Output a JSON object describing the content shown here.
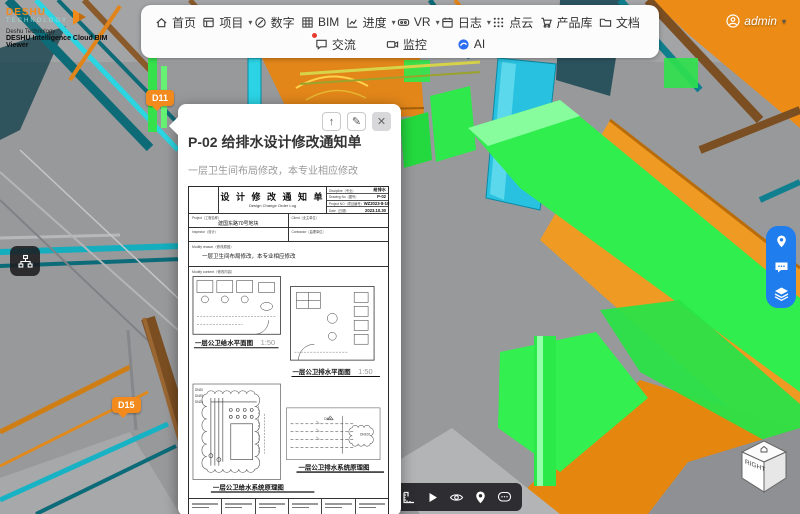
{
  "brand": {
    "logo_line1": "DESHU",
    "logo_line2": "TECHNOLOGY",
    "sub_line1": "Deshu Technology",
    "sub_line2": "DESHU Intelligence Cloud BIM Viewer"
  },
  "nav": {
    "row1": [
      {
        "label": "首页",
        "caret": ""
      },
      {
        "label": "项目",
        "caret": "▾"
      },
      {
        "label": "数字",
        "caret": ""
      },
      {
        "label": "BIM",
        "caret": ""
      },
      {
        "label": "进度",
        "caret": "▾"
      },
      {
        "label": "VR",
        "caret": "▾"
      },
      {
        "label": "日志",
        "caret": "▾"
      },
      {
        "label": "点云",
        "caret": ""
      },
      {
        "label": "产品库",
        "caret": ""
      },
      {
        "label": "文档",
        "caret": ""
      }
    ],
    "row2": [
      {
        "label": "交流"
      },
      {
        "label": "监控"
      },
      {
        "label": "AI"
      }
    ]
  },
  "user": {
    "name": "admin",
    "caret": "▾"
  },
  "markers": {
    "d11": "D11",
    "d15": "D15"
  },
  "popup": {
    "title": "P-02 给排水设计修改通知单",
    "subtitle": "一层卫生间布局修改，本专业相应修改",
    "actions": {
      "share": "↑",
      "edit": "✎",
      "close": "✕"
    },
    "doc": {
      "title_cn": "设 计 修 改 通 知 单",
      "title_en": "Design Change Order Log",
      "meta": [
        {
          "label": "Discipline（专业）",
          "value": "给排水"
        },
        {
          "label": "Drawing No（图号）",
          "value": "P-02"
        },
        {
          "label": "Project NO（项目编号）",
          "value": "WZ2023-8-10"
        },
        {
          "label": "Date（日期）",
          "value": "2023.10.30"
        }
      ],
      "info_rows": [
        {
          "l1": "Project（工程名称）",
          "v1": "建国东路70号地块",
          "l2": "Client（业主单位）",
          "v2": ""
        },
        {
          "l1": "Inspector（设计）",
          "v1": "",
          "l2": "Contractor（监理单位）",
          "v2": ""
        }
      ],
      "reason_label": "Modify reason（修改原因）",
      "reason_text": "一层卫生间布局修改，本专业相应修改",
      "content_label": "Modify content（修改内容）",
      "drawings": {
        "plan_water_caption": "一层公卫给水平面图",
        "plan_drain_caption": "一层公卫排水平面图",
        "scale": "1:50",
        "schematic_water_caption": "一层公卫给水系统原理图",
        "schematic_drain_caption": "一层公卫排水系统原理图",
        "dn_labels": [
          "DN20",
          "DN25",
          "DN25",
          "DN50",
          "DN100"
        ]
      }
    }
  },
  "viewcube": {
    "face_label": "RIGHT"
  }
}
